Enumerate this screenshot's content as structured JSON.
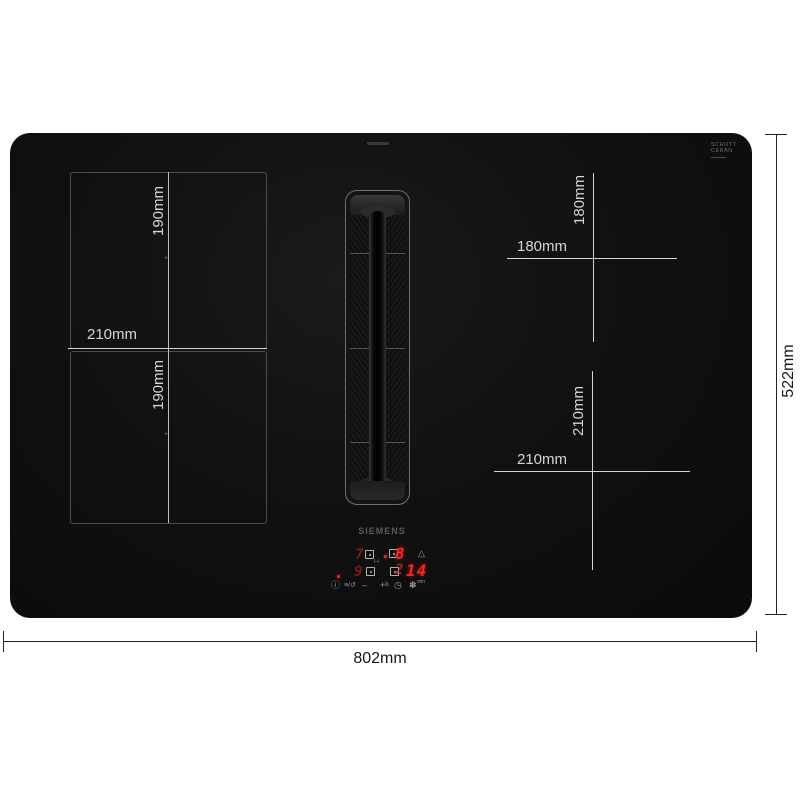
{
  "hob": {
    "brand": "SIEMENS",
    "glass_label": {
      "line1": "SCHOTT",
      "line2": "CERAN"
    },
    "zones": {
      "top_left_height": "190mm",
      "bottom_left_height": "190mm",
      "left_width": "210mm",
      "top_right_height": "180mm",
      "top_right_width": "180mm",
      "bottom_right_height": "210mm",
      "bottom_right_width": "210mm",
      "pan_marker": "+"
    },
    "display": {
      "power_level": "8",
      "ghost_zone_top": "7",
      "ghost_zone_bottom": "9",
      "ghost_timer": "2",
      "timer_value": "14",
      "timer_unit": "min"
    },
    "icons": {
      "warning_triangle": "△",
      "bridge": "I–I",
      "info": "ⓘ",
      "filter_clean": "≡/↺",
      "minus": "–",
      "plus": "+ᵇ",
      "timer_clock": "◷",
      "fan": "✽"
    }
  },
  "outer_dimensions": {
    "width": "802mm",
    "height": "522mm"
  },
  "colors": {
    "hob_glass": "#0e0e0e",
    "on_glass_line": "#d4d4d4",
    "zone_border": "#4c4c4c",
    "led_red": "#ff2222",
    "dimension_line": "#232323",
    "background": "#ffffff"
  }
}
